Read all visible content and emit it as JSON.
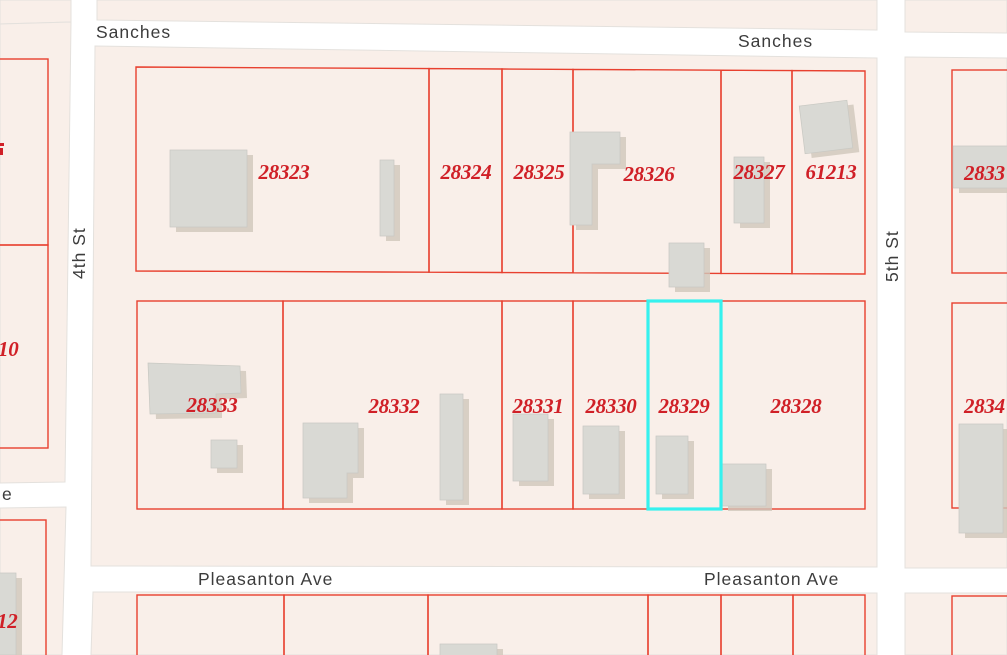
{
  "streets": {
    "sanches_west": "Sanches",
    "sanches_east": "Sanches",
    "fourth_st": "4th St",
    "fifth_st": "5th St",
    "pleasanton_west": "Pleasanton Ave",
    "pleasanton_east": "Pleasanton Ave",
    "west_avenue_partial": "e"
  },
  "parcels": {
    "north_block": [
      "28323",
      "28324",
      "28325",
      "28326",
      "28327",
      "61213"
    ],
    "south_block": [
      "28333",
      "28332",
      "28331",
      "28330",
      "28329",
      "28328"
    ],
    "west_edge": [
      "10",
      "12"
    ],
    "east_edge": [
      "2833",
      "2834"
    ],
    "selected_parcel": "28329"
  },
  "colors": {
    "block_fill": "#f9efe9",
    "block_border": "#e4e1dd",
    "road_fill": "#ffffff",
    "parcel_line": "#e8402f",
    "parcel_label": "#d02027",
    "highlight": "#36f1ee",
    "building_fill": "#d9d9d4",
    "building_shadow": "#cfc7ba",
    "street_label": "#3c3c3c"
  }
}
